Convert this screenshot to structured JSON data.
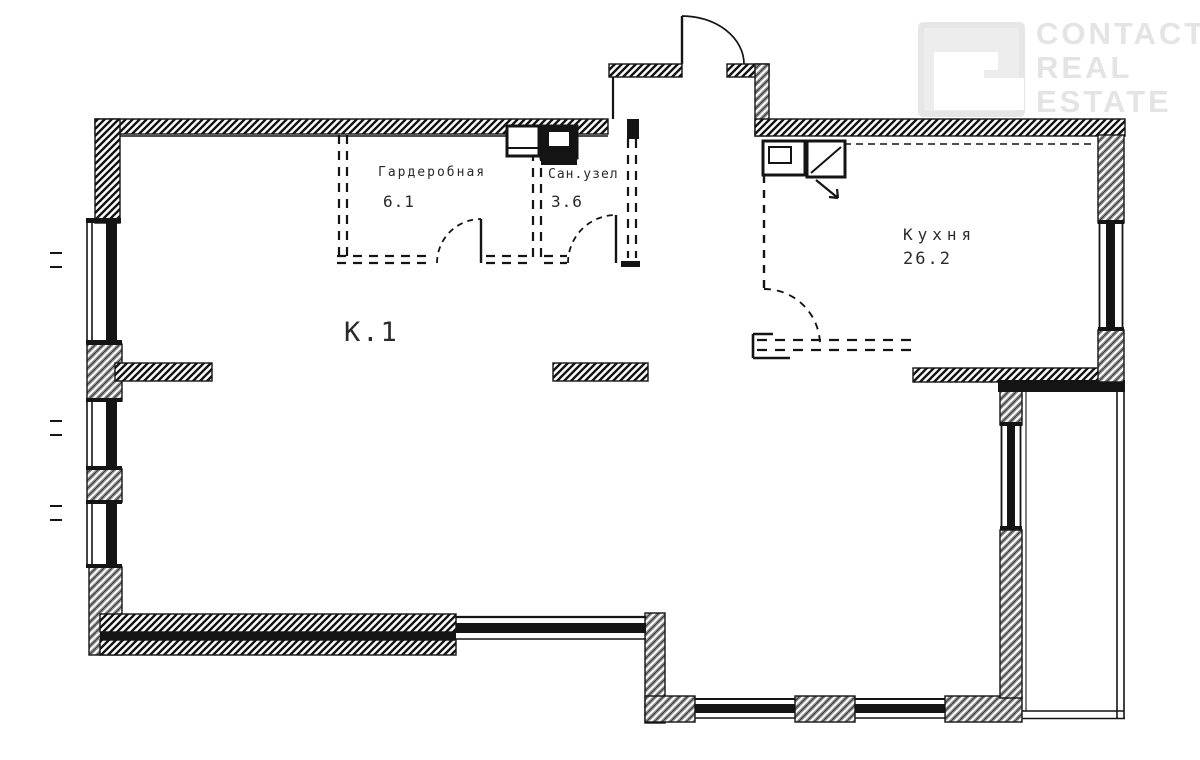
{
  "watermark": {
    "icon": "contact-real-estate-logo",
    "lines": [
      "CONTACT",
      "REAL",
      "ESTATE"
    ],
    "color": "#e2e2e2"
  },
  "plan": {
    "rooms": {
      "room1": {
        "label": "К.1"
      },
      "kitchen": {
        "name": "Кухня",
        "area": "26.2"
      },
      "dressing": {
        "name": "Гардеробная",
        "area": "6.1"
      },
      "bathroom": {
        "name": "Сан.узел",
        "area": "3.6"
      }
    }
  },
  "colors": {
    "ink": "#141414",
    "wall_gray": "#8f8f8f",
    "watermark_gray": "#e2e2e2",
    "background": "#ffffff"
  }
}
